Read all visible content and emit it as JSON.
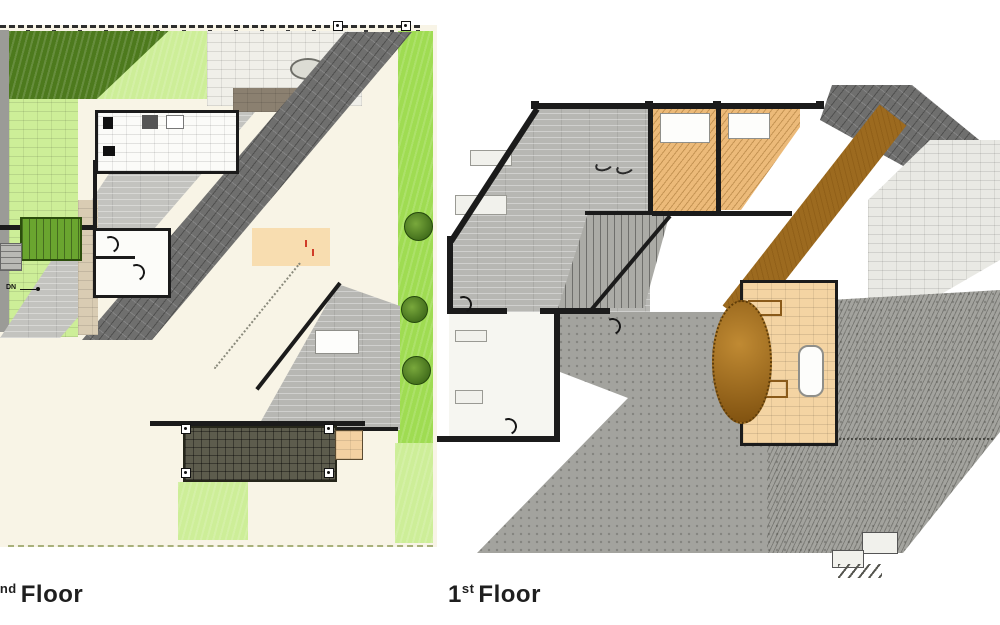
{
  "page": {
    "background": "#ffffff"
  },
  "plans": {
    "second_floor": {
      "label": {
        "number": "2",
        "ordinal": "nd",
        "word": "Floor"
      },
      "stair_direction_note": "DN"
    },
    "first_floor": {
      "label": {
        "number": "1",
        "ordinal": "st",
        "word": "Floor"
      }
    }
  },
  "palette": {
    "page_bg": "#ffffff",
    "wall": "#1b1b1b",
    "ground_cream": "#f8f4e6",
    "grass_dark": "#4d7a1d",
    "grass_light": "#cdee98",
    "grass_bright": "#9fdc52",
    "stair_green": "#6aa52f",
    "shingle_dark": "#6f6f6e",
    "shingle_light": "#c3c3bf",
    "plank_gray": "#b7b7b3",
    "wood_orange": "#ecba79",
    "wood_brown": "#9c6a1f",
    "tile_light": "#e9e9e4",
    "tile_peach": "#f3d1a2",
    "paving_gray": "#a3a39e",
    "deck_dark": "#5d5c4d",
    "bath_tan": "#f4d4a3",
    "label_color": "#1f1f1f",
    "boundary_dash": "#a8b07a",
    "accent_red": "#d03c28"
  },
  "icons": {
    "door_swing": "quarter-arc",
    "fence_post": "square with dot",
    "shrub": "dark-green circle",
    "tree": "brown dotted circle",
    "patio_table": "gray oval",
    "down_arrow": "line with end dot"
  }
}
